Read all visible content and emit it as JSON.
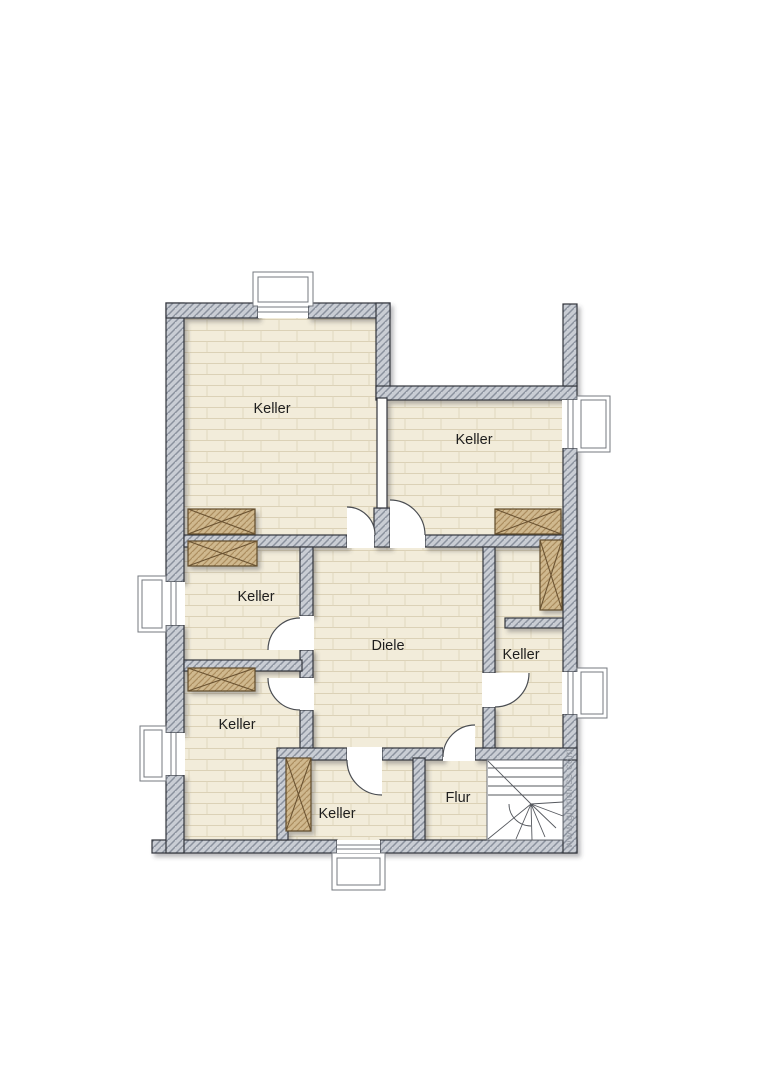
{
  "plan": {
    "rooms": [
      {
        "id": "keller-top-left",
        "label": "Keller"
      },
      {
        "id": "keller-top-right",
        "label": "Keller"
      },
      {
        "id": "keller-middle-left",
        "label": "Keller"
      },
      {
        "id": "hall",
        "label": "Diele"
      },
      {
        "id": "keller-right",
        "label": "Keller"
      },
      {
        "id": "keller-bottom-left",
        "label": "Keller"
      },
      {
        "id": "keller-bottom-center",
        "label": "Keller"
      },
      {
        "id": "corridor",
        "label": "Flur"
      }
    ],
    "watermark": "www.grundriss.com",
    "features": {
      "windows": 6,
      "doors": 7,
      "chimney_blocks": 6,
      "staircase": "winder-staircase"
    },
    "colors": {
      "background": "#ffffff",
      "floor": "#f2ecda",
      "floor_joint": "#dbd1b6",
      "wall_fill": "#c9cdd4",
      "wall_hatch": "#8a919d",
      "wall_outline": "#33363c",
      "wood_fill": "#cfb88e",
      "wood_hatch": "#ab8d5f",
      "wood_outline": "#5f4b2c",
      "label_text": "#1e1e1e",
      "watermark_text": "#8f949d"
    }
  }
}
